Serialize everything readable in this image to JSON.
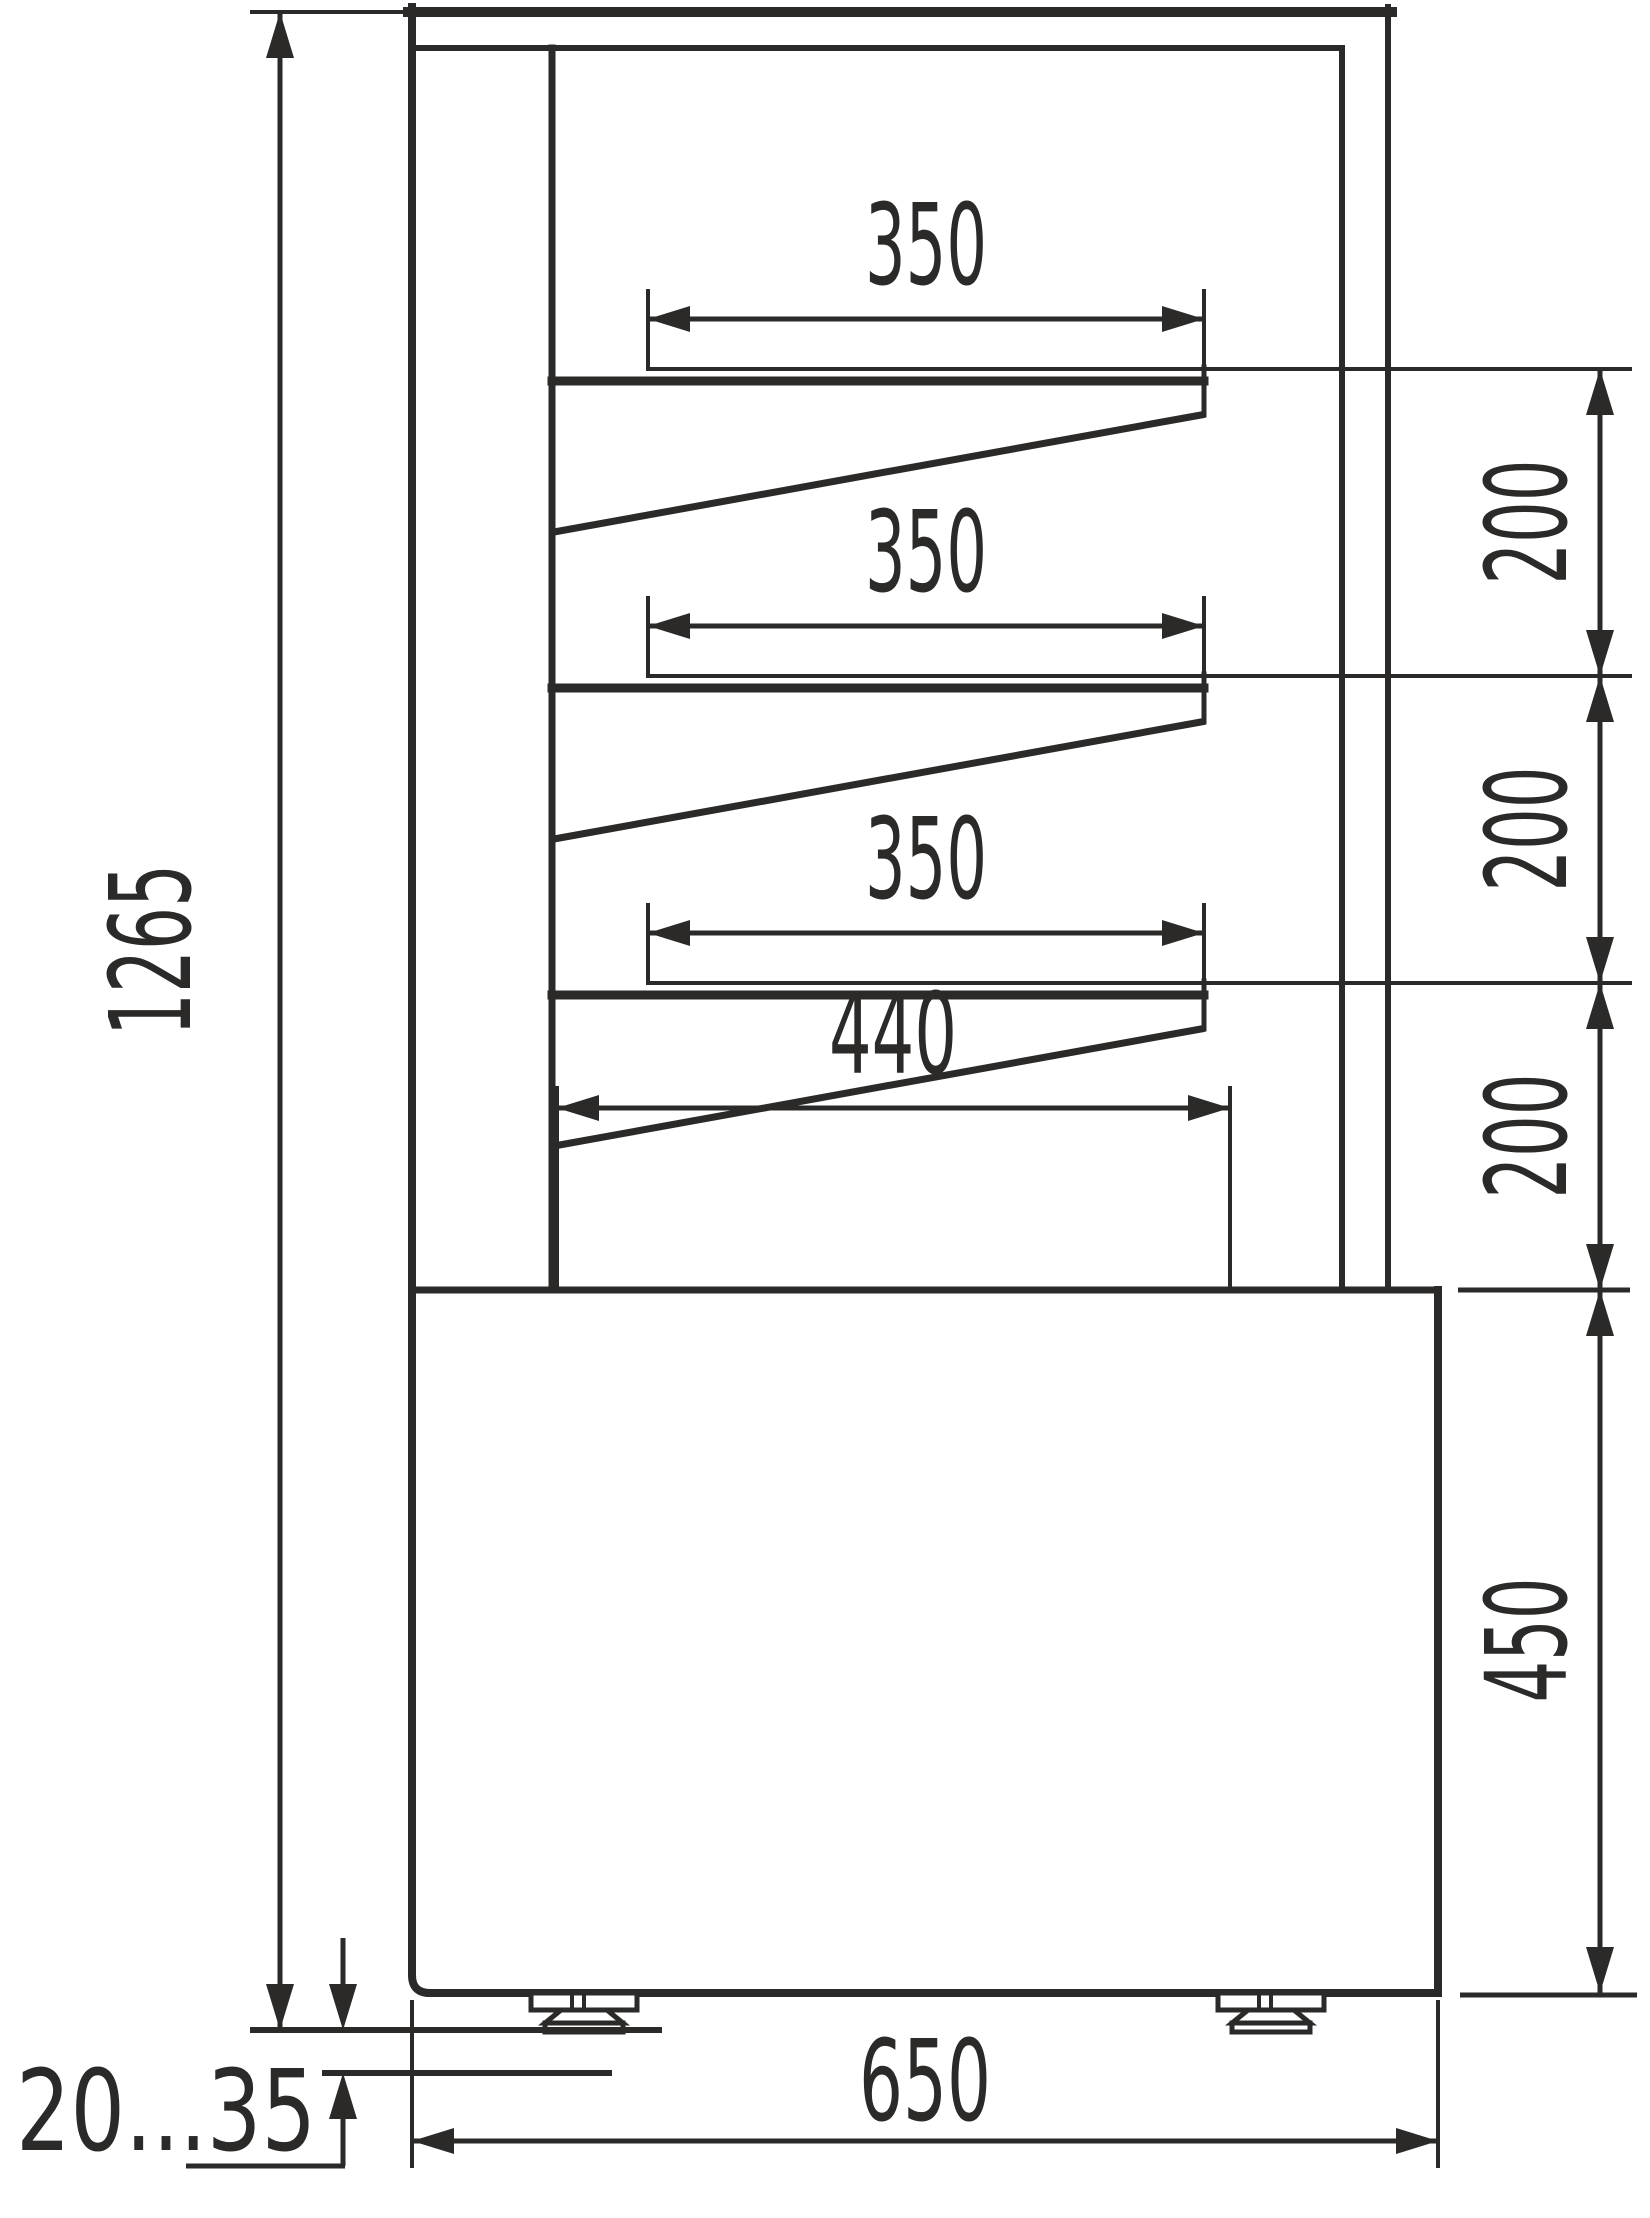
{
  "drawing": {
    "kind": "technical-dimension-drawing",
    "background_color": "#ffffff",
    "line_color": "#2b2a29",
    "dimensions": {
      "overall_height": "1265",
      "shelf_1_depth": "350",
      "shelf_2_depth": "350",
      "shelf_3_depth": "350",
      "shelf_gap_1": "200",
      "shelf_gap_2": "200",
      "shelf_gap_3": "200",
      "bottom_shelf_depth": "440",
      "base_height": "450",
      "overall_depth": "650",
      "feet_adjust_range": "20...35"
    }
  }
}
